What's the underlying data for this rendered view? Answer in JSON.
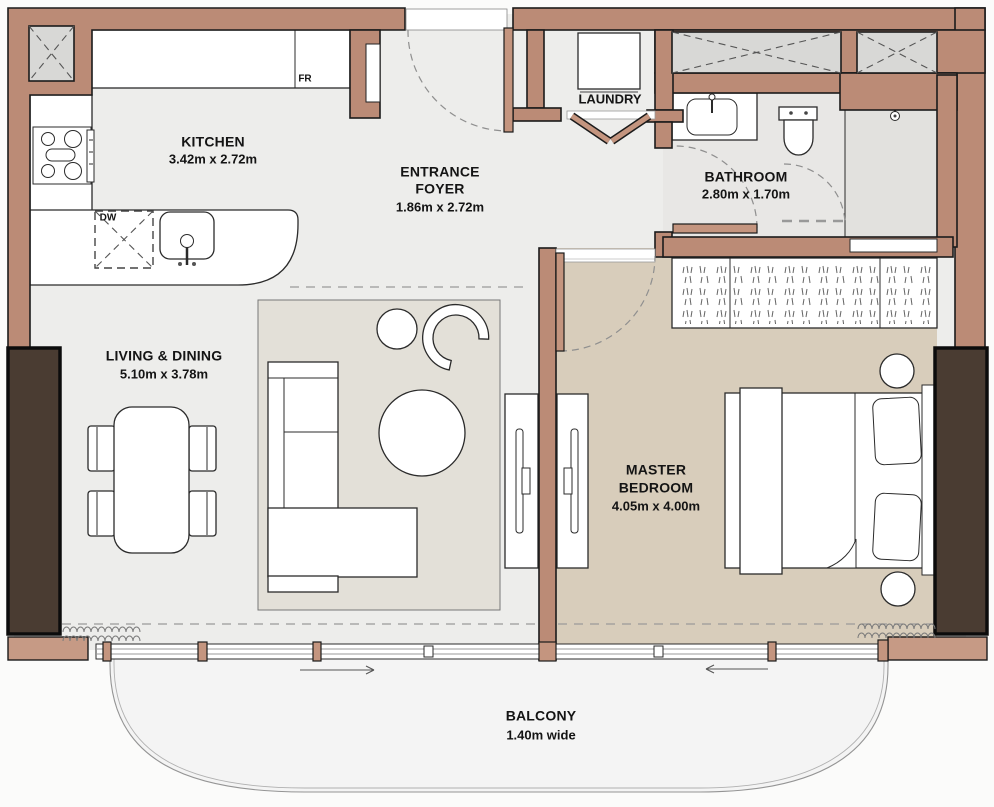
{
  "floorplan": {
    "rooms": {
      "kitchen": {
        "name": "KITCHEN",
        "dims": "3.42m x 2.72m"
      },
      "entrance_foyer": {
        "line1": "ENTRANCE",
        "line2": "FOYER",
        "dims": "1.86m x 2.72m"
      },
      "laundry": {
        "name": "LAUNDRY"
      },
      "bathroom": {
        "name": "BATHROOM",
        "dims": "2.80m x 1.70m"
      },
      "living_dining": {
        "name": "LIVING & DINING",
        "dims": "5.10m x 3.78m"
      },
      "master_bedroom": {
        "line1": "MASTER",
        "line2": "BEDROOM",
        "dims": "4.05m x 4.00m"
      },
      "balcony": {
        "name": "BALCONY",
        "dims": "1.40m wide"
      }
    },
    "appliance_tags": {
      "fridge": "FR",
      "dishwasher": "DW"
    },
    "colors": {
      "wall": "#bb8b76",
      "wall_light": "#c69a85",
      "outline": "#1b1b1b",
      "floor": "#ededeb",
      "bedroom_floor": "#d8cdbb",
      "bathroom_floor": "#e8e7e5",
      "shower_floor": "#e2e1de",
      "rug": "#e3e0d8",
      "shaft": "#d8d8d6",
      "dark_glazing": "#4a3c32",
      "balcony_floor": "#f4f4f4"
    }
  }
}
